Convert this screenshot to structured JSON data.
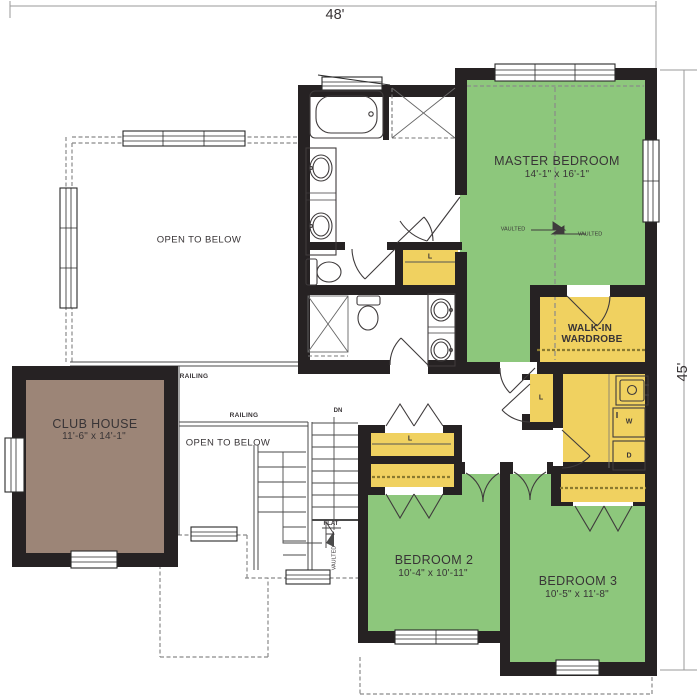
{
  "colors": {
    "room_green": "#8dc77c",
    "closet_yellow": "#f0d160",
    "club_brown": "#9c8577",
    "wall": "#262223"
  },
  "dimensions": {
    "width": "48'",
    "height": "45'"
  },
  "rooms": {
    "master_bedroom": {
      "name": "MASTER BEDROOM",
      "size": "14'-1\" x 16'-1\""
    },
    "walk_in_wardrobe": {
      "name_line1": "WALK-IN",
      "name_line2": "WARDROBE"
    },
    "club_house": {
      "name": "CLUB HOUSE",
      "size": "11'-6\" x 14'-1\""
    },
    "bedroom_2": {
      "name": "BEDROOM 2",
      "size": "10'-4\" x 10'-11\""
    },
    "bedroom_3": {
      "name": "BEDROOM 3",
      "size": "10'-5\" x 11'-8\""
    },
    "open_to_below_upper": "OPEN TO BELOW",
    "open_to_below_stairs": "OPEN TO BELOW"
  },
  "labels": {
    "railing": "RAILING",
    "dn": "DN",
    "flat": "FLAT",
    "vaulted": "VAULTED",
    "linen": "L",
    "washer": "W",
    "dryer": "D"
  }
}
